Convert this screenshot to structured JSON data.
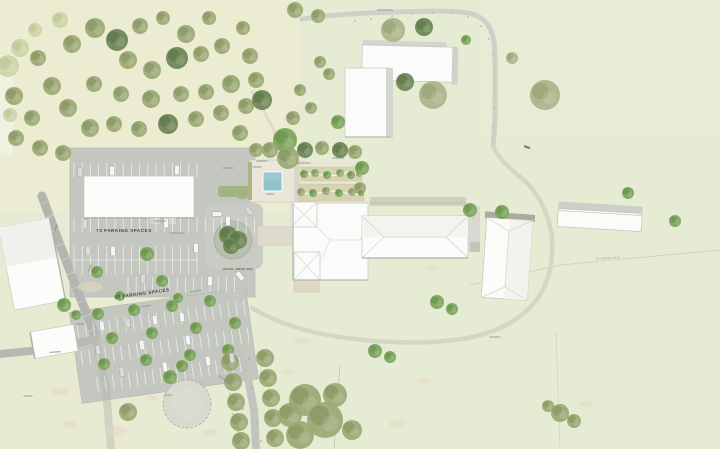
{
  "page_title": "Landscape architecture site plan",
  "labels": {
    "parking_upper": "73 PARKING SPACES",
    "parking_lower": "52 PARKING SPACES",
    "drop_off": "HOTEL DROP OFF",
    "mowed_path": "EX MOWED PATH"
  },
  "colors": {
    "meadow": "#e6ebd4",
    "orchard_ground": "#ebecd0",
    "road": "#c6c9c2",
    "asphalt": "#c4c7c0",
    "building_white": "#fbfbf9",
    "roof_shade": "#f2f2ee",
    "shadow": "#b3b7ad",
    "pool_water": "#8fc2ce",
    "garden_bed": "#d6d2b2",
    "tree_olive": "#9aa873",
    "tree_dark": "#6b8454",
    "tree_bright": "#7aa45a",
    "label_dark": "#41463f"
  },
  "map_features": {
    "trees": [
      [
        14,
        96,
        9,
        "o"
      ],
      [
        32,
        118,
        8,
        "o"
      ],
      [
        52,
        86,
        9,
        "o"
      ],
      [
        38,
        58,
        8,
        "o"
      ],
      [
        72,
        44,
        9,
        "o"
      ],
      [
        95,
        28,
        10,
        "o"
      ],
      [
        117,
        40,
        11,
        "d"
      ],
      [
        140,
        26,
        8,
        "o"
      ],
      [
        163,
        18,
        7,
        "o"
      ],
      [
        186,
        34,
        9,
        "o"
      ],
      [
        128,
        60,
        9,
        "o"
      ],
      [
        152,
        70,
        9,
        "o"
      ],
      [
        177,
        58,
        11,
        "d"
      ],
      [
        201,
        54,
        8,
        "o"
      ],
      [
        222,
        46,
        8,
        "o"
      ],
      [
        243,
        28,
        7,
        "o"
      ],
      [
        209,
        18,
        7,
        "o"
      ],
      [
        250,
        56,
        8,
        "o"
      ],
      [
        256,
        80,
        8,
        "o"
      ],
      [
        231,
        84,
        9,
        "o"
      ],
      [
        206,
        92,
        8,
        "o"
      ],
      [
        181,
        94,
        8,
        "o"
      ],
      [
        151,
        99,
        9,
        "o"
      ],
      [
        121,
        94,
        8,
        "o"
      ],
      [
        94,
        84,
        8,
        "o"
      ],
      [
        68,
        108,
        9,
        "o"
      ],
      [
        90,
        128,
        9,
        "o"
      ],
      [
        114,
        124,
        8,
        "o"
      ],
      [
        139,
        129,
        8,
        "o"
      ],
      [
        168,
        124,
        10,
        "d"
      ],
      [
        196,
        119,
        8,
        "o"
      ],
      [
        221,
        113,
        8,
        "o"
      ],
      [
        246,
        106,
        8,
        "o"
      ],
      [
        16,
        138,
        8,
        "o"
      ],
      [
        40,
        148,
        8,
        "o"
      ],
      [
        63,
        153,
        8,
        "o"
      ],
      [
        240,
        133,
        8,
        "o"
      ],
      [
        256,
        150,
        7,
        "o"
      ],
      [
        8,
        66,
        11,
        "l"
      ],
      [
        20,
        48,
        9,
        "l"
      ],
      [
        60,
        20,
        8,
        "l"
      ],
      [
        35,
        30,
        7,
        "l"
      ],
      [
        10,
        115,
        7,
        "l"
      ],
      [
        295,
        10,
        8,
        "o"
      ],
      [
        318,
        16,
        7,
        "o"
      ],
      [
        262,
        100,
        10,
        "d"
      ],
      [
        285,
        140,
        12,
        "b"
      ],
      [
        270,
        150,
        8,
        "o"
      ],
      [
        293,
        118,
        7,
        "o"
      ],
      [
        320,
        62,
        6,
        "o"
      ],
      [
        329,
        74,
        6,
        "o"
      ],
      [
        338,
        122,
        7,
        "b"
      ],
      [
        300,
        90,
        6,
        "o"
      ],
      [
        311,
        108,
        6,
        "o"
      ],
      [
        393,
        30,
        12,
        "s"
      ],
      [
        424,
        27,
        9,
        "d"
      ],
      [
        466,
        40,
        5,
        "b"
      ],
      [
        512,
        58,
        6,
        "s"
      ],
      [
        405,
        82,
        9,
        "d"
      ],
      [
        433,
        95,
        14,
        "s"
      ],
      [
        545,
        95,
        15,
        "s"
      ],
      [
        305,
        150,
        8,
        "d"
      ],
      [
        322,
        148,
        7,
        "o"
      ],
      [
        340,
        150,
        8,
        "d"
      ],
      [
        355,
        152,
        7,
        "o"
      ],
      [
        362,
        168,
        7,
        "b"
      ],
      [
        360,
        188,
        6,
        "o"
      ],
      [
        288,
        158,
        11,
        "o"
      ],
      [
        304,
        174,
        4,
        "b"
      ],
      [
        315,
        173,
        4,
        "o"
      ],
      [
        327,
        175,
        4,
        "b"
      ],
      [
        340,
        173,
        4,
        "o"
      ],
      [
        351,
        175,
        4,
        "b"
      ],
      [
        359,
        174,
        3,
        "o"
      ],
      [
        301,
        192,
        4,
        "o"
      ],
      [
        313,
        193,
        4,
        "b"
      ],
      [
        326,
        191,
        4,
        "o"
      ],
      [
        339,
        193,
        4,
        "b"
      ],
      [
        352,
        192,
        4,
        "o"
      ],
      [
        361,
        193,
        3,
        "b"
      ],
      [
        628,
        193,
        6,
        "b"
      ],
      [
        675,
        221,
        6,
        "b"
      ],
      [
        470,
        210,
        7,
        "b"
      ],
      [
        502,
        212,
        7,
        "b"
      ],
      [
        437,
        302,
        7,
        "b"
      ],
      [
        452,
        309,
        6,
        "b"
      ],
      [
        375,
        351,
        7,
        "b"
      ],
      [
        390,
        357,
        6,
        "b"
      ],
      [
        560,
        413,
        9,
        "o"
      ],
      [
        574,
        421,
        7,
        "o"
      ],
      [
        548,
        406,
        6,
        "o"
      ],
      [
        228,
        235,
        9,
        "d"
      ],
      [
        238,
        240,
        9,
        "d"
      ],
      [
        231,
        246,
        8,
        "d"
      ],
      [
        97,
        272,
        6,
        "b"
      ],
      [
        147,
        254,
        7,
        "b"
      ],
      [
        162,
        281,
        6,
        "b"
      ],
      [
        120,
        296,
        5,
        "b"
      ],
      [
        178,
        298,
        5,
        "b"
      ],
      [
        64,
        305,
        7,
        "b"
      ],
      [
        76,
        315,
        5,
        "b"
      ],
      [
        98,
        314,
        6,
        "b"
      ],
      [
        134,
        310,
        6,
        "b"
      ],
      [
        172,
        306,
        6,
        "b"
      ],
      [
        210,
        301,
        6,
        "b"
      ],
      [
        112,
        338,
        6,
        "b"
      ],
      [
        152,
        333,
        6,
        "b"
      ],
      [
        196,
        328,
        6,
        "b"
      ],
      [
        235,
        323,
        6,
        "b"
      ],
      [
        104,
        364,
        6,
        "b"
      ],
      [
        146,
        360,
        6,
        "b"
      ],
      [
        190,
        355,
        6,
        "b"
      ],
      [
        228,
        350,
        6,
        "b"
      ],
      [
        230,
        362,
        9,
        "o"
      ],
      [
        233,
        382,
        9,
        "o"
      ],
      [
        236,
        402,
        9,
        "o"
      ],
      [
        239,
        422,
        9,
        "o"
      ],
      [
        241,
        441,
        9,
        "o"
      ],
      [
        265,
        358,
        9,
        "o"
      ],
      [
        268,
        378,
        9,
        "o"
      ],
      [
        271,
        398,
        9,
        "o"
      ],
      [
        273,
        418,
        9,
        "o"
      ],
      [
        275,
        438,
        9,
        "o"
      ],
      [
        305,
        400,
        16,
        "o"
      ],
      [
        325,
        420,
        18,
        "o"
      ],
      [
        300,
        435,
        14,
        "o"
      ],
      [
        335,
        395,
        12,
        "o"
      ],
      [
        290,
        415,
        12,
        "o"
      ],
      [
        352,
        430,
        10,
        "o"
      ],
      [
        128,
        412,
        9,
        "o"
      ],
      [
        170,
        377,
        7,
        "b"
      ],
      [
        182,
        366,
        6,
        "b"
      ]
    ],
    "cars": [
      [
        80,
        172,
        0
      ],
      [
        112,
        171,
        0
      ],
      [
        177,
        170,
        0
      ],
      [
        85,
        224,
        0
      ],
      [
        166,
        223,
        0
      ],
      [
        228,
        221,
        0
      ],
      [
        88,
        251,
        0
      ],
      [
        113,
        251,
        0
      ],
      [
        196,
        248,
        0
      ],
      [
        143,
        279,
        0
      ],
      [
        210,
        281,
        0
      ],
      [
        217,
        214,
        90
      ],
      [
        249,
        211,
        -35
      ],
      [
        240,
        276,
        -38
      ],
      [
        102,
        326,
        -8
      ],
      [
        128,
        323,
        -8
      ],
      [
        155,
        320,
        -8
      ],
      [
        182,
        317,
        -8
      ],
      [
        98,
        350,
        -8
      ],
      [
        142,
        345,
        -8
      ],
      [
        188,
        340,
        -8
      ],
      [
        122,
        372,
        -8
      ],
      [
        165,
        367,
        -8
      ],
      [
        208,
        361,
        -8
      ],
      [
        232,
        358,
        -8
      ]
    ],
    "label_marks": [
      [
        160,
        221,
        13,
        0
      ],
      [
        177,
        233,
        15,
        0
      ],
      [
        242,
        198,
        10,
        0
      ],
      [
        228,
        168,
        11,
        0
      ],
      [
        262,
        161,
        11,
        0
      ],
      [
        257,
        167,
        9,
        0
      ],
      [
        270,
        194,
        8,
        0
      ],
      [
        303,
        163,
        15,
        0
      ],
      [
        338,
        158,
        12,
        0
      ],
      [
        292,
        117,
        13,
        0
      ],
      [
        385,
        10,
        16,
        0
      ],
      [
        56,
        228,
        8,
        -70
      ],
      [
        90,
        268,
        8,
        -70
      ],
      [
        80,
        324,
        9,
        0
      ],
      [
        55,
        352,
        11,
        -4
      ],
      [
        28,
        396,
        9,
        0
      ],
      [
        168,
        395,
        8,
        0
      ],
      [
        222,
        378,
        9,
        35
      ],
      [
        495,
        337,
        11,
        0
      ],
      [
        528,
        148,
        5,
        20
      ],
      [
        146,
        306,
        10,
        -8
      ],
      [
        196,
        291,
        12,
        -8
      ]
    ],
    "grass_patches": [
      [
        90,
        287,
        13,
        5
      ],
      [
        60,
        391,
        10,
        4
      ],
      [
        116,
        431,
        12,
        5
      ],
      [
        152,
        398,
        7,
        3
      ],
      [
        210,
        433,
        8,
        4
      ],
      [
        398,
        424,
        9,
        4
      ],
      [
        424,
        381,
        7,
        3
      ],
      [
        302,
        341,
        8,
        3
      ],
      [
        586,
        404,
        7,
        3
      ],
      [
        432,
        268,
        7,
        3
      ],
      [
        288,
        372,
        7,
        3
      ],
      [
        70,
        425,
        8,
        4
      ]
    ],
    "road_dots": [
      [
        355,
        21
      ],
      [
        371,
        19
      ],
      [
        392,
        16
      ],
      [
        412,
        14
      ],
      [
        433,
        13
      ],
      [
        452,
        13
      ],
      [
        468,
        17
      ],
      [
        481,
        26
      ],
      [
        489,
        39
      ],
      [
        493,
        55
      ],
      [
        494,
        72
      ],
      [
        494,
        90
      ],
      [
        494,
        108
      ],
      [
        493,
        126
      ]
    ],
    "leaf_dots": [
      [
        246,
        371
      ],
      [
        252,
        388
      ],
      [
        243,
        409
      ],
      [
        257,
        424
      ],
      [
        238,
        431
      ],
      [
        261,
        441
      ],
      [
        233,
        414
      ],
      [
        249,
        359
      ],
      [
        266,
        405
      ],
      [
        230,
        394
      ]
    ]
  }
}
